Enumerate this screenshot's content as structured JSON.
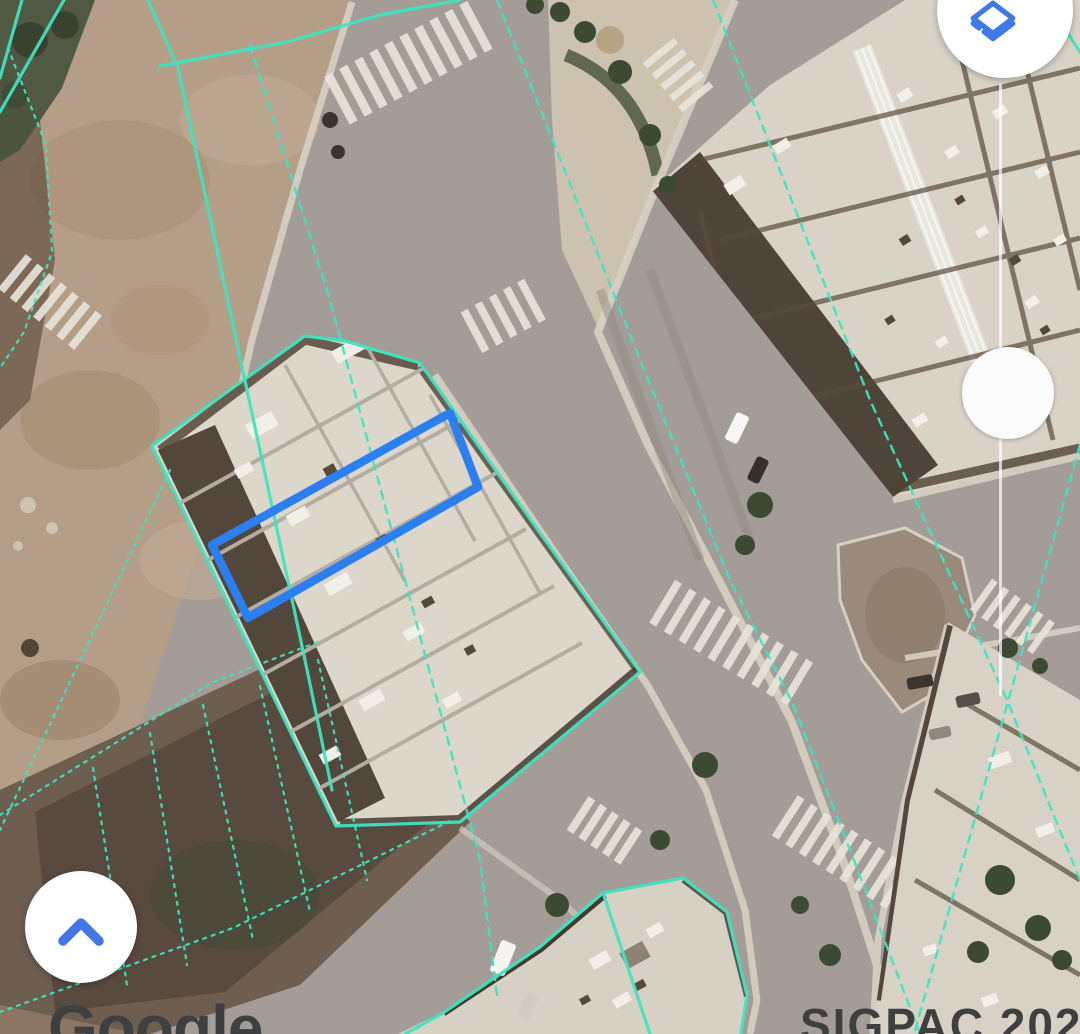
{
  "map": {
    "watermark_left": "Google",
    "watermark_right": "SIGPAC 2020",
    "overlay_colors": {
      "parcel_lines": "#3EE4C0",
      "selection_outline": "#2B7FF0"
    }
  },
  "controls": {
    "layers_button": {
      "icon": "layers-icon",
      "icon_color": "#3D79E8",
      "background": "#FFFFFF"
    },
    "opacity_slider": {
      "orientation": "vertical",
      "track_color": "#FFFFFF",
      "thumb_color": "#FBFBFB"
    },
    "collapse_button": {
      "icon": "chevron-up-icon",
      "icon_color": "#4377E5",
      "background": "#FFFFFF"
    }
  }
}
